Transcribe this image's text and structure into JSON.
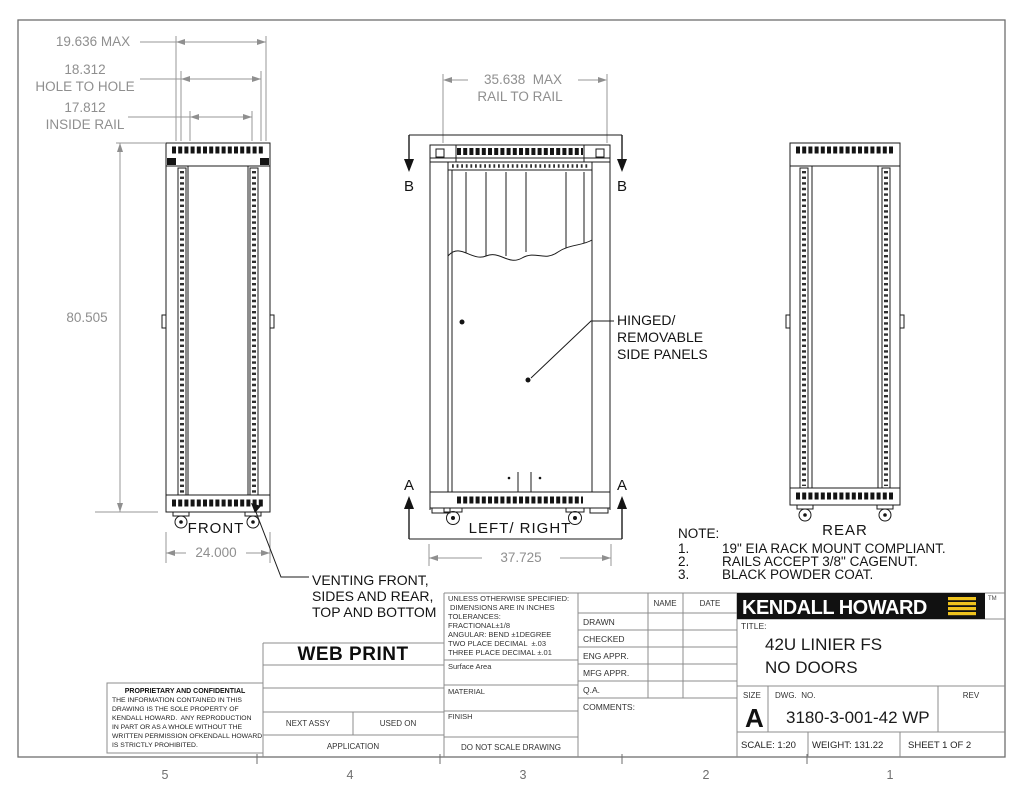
{
  "colors": {
    "logo_bg": "#111111",
    "logo_accent": "#EFC31E",
    "dim_text": "#8f8f8f",
    "line": "#1b1b1b"
  },
  "sheet": {
    "zones": [
      "5",
      "4",
      "3",
      "2",
      "1"
    ]
  },
  "sections": {
    "a": "A",
    "b": "B"
  },
  "views": {
    "front": "FRONT",
    "side": "LEFT/ RIGHT",
    "rear": "REAR"
  },
  "dims": {
    "width_max": "19.636 MAX",
    "hole_to_hole_value": "18.312",
    "hole_to_hole_label": "HOLE TO HOLE",
    "inside_rail_value": "17.812",
    "inside_rail_label": "INSIDE RAIL",
    "height": "80.505",
    "rail_to_rail_value": "35.638  MAX",
    "rail_to_rail_label": "RAIL TO RAIL",
    "front_width": "24.000",
    "depth": "37.725"
  },
  "callouts": {
    "hinged": [
      "HINGED/",
      "REMOVABLE",
      "SIDE PANELS"
    ],
    "venting": [
      "VENTING FRONT,",
      "SIDES AND REAR,",
      "TOP AND BOTTOM"
    ]
  },
  "note": {
    "title": "NOTE:",
    "items": [
      {
        "n": "1.",
        "t": "19\" EIA RACK MOUNT COMPLIANT."
      },
      {
        "n": "2.",
        "t": "RAILS ACCEPT 3/8\" CAGENUT."
      },
      {
        "n": "3.",
        "t": "BLACK POWDER COAT."
      }
    ]
  },
  "title_block": {
    "spec_lines": [
      "UNLESS OTHERWISE SPECIFIED:",
      "DIMENSIONS ARE IN INCHES",
      "TOLERANCES:",
      "FRACTIONAL±1/8",
      "ANGULAR: BEND ±1DEGREE",
      "TWO PLACE DECIMAL  ±.03",
      "THREE PLACE DECIMAL ±.01"
    ],
    "surface_area": "Surface Area",
    "material": "MATERIAL",
    "finish": "FINISH",
    "do_not_scale": "DO NOT SCALE DRAWING",
    "name_header": "NAME",
    "date_header": "DATE",
    "rows": [
      "DRAWN",
      "CHECKED",
      "ENG APPR.",
      "MFG APPR.",
      "Q.A."
    ],
    "comments": "COMMENTS:",
    "logo": "KENDALL HOWARD",
    "tm": "TM",
    "title_label": "TITLE:",
    "title_line1": "42U LINIER FS",
    "title_line2": "NO DOORS",
    "size_label": "SIZE",
    "size": "A",
    "dwg_label": "DWG.  NO.",
    "dwg_no": "3180-3-001-42 WP",
    "rev_label": "REV",
    "scale": "SCALE: 1:20",
    "weight": "WEIGHT: 131.22",
    "sheet": "SHEET 1 OF 2",
    "web_print": "WEB PRINT",
    "next_assy": "NEXT ASSY",
    "used_on": "USED ON",
    "application": "APPLICATION",
    "prop_title": "PROPRIETARY AND CONFIDENTIAL",
    "prop_lines": [
      "THE INFORMATION CONTAINED IN THIS",
      "DRAWING IS THE SOLE PROPERTY OF",
      "KENDALL HOWARD.  ANY REPRODUCTION",
      "IN PART OR AS A WHOLE WITHOUT THE",
      "WRITTEN PERMISSION OFKENDALL HOWARD",
      "IS STRICTLY PROHIBITED."
    ]
  }
}
